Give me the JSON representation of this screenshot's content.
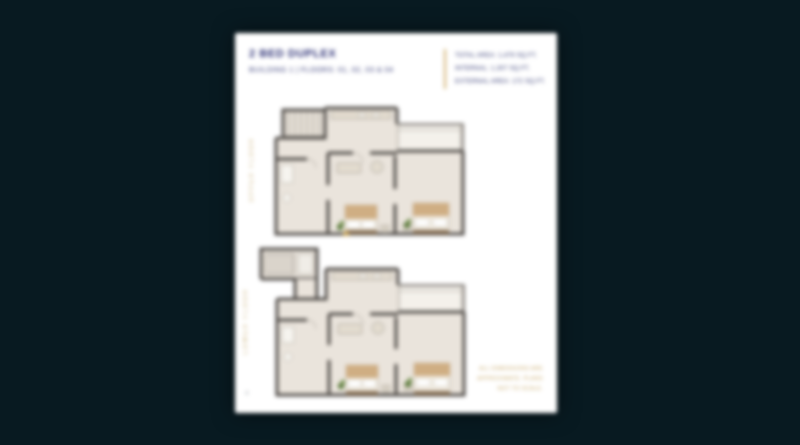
{
  "page": {
    "background_color": "#081a21",
    "paper_color": "#ffffff"
  },
  "header": {
    "title": "2 BED DUPLEX",
    "subtitle": "BUILDING 1  |  FLOORS: 01, 02, 03 & 04",
    "area_lines": [
      "TOTAL AREA: 1,479 SQ.FT.",
      "INTERNAL: 1,307 SQ.FT.",
      "EXTERNAL AREA: 172 SQ.FT."
    ]
  },
  "plans": [
    {
      "id": "upper-floor",
      "label": "UPPER FLOOR"
    },
    {
      "id": "lower-floor",
      "label": "LOWER FLOOR"
    }
  ],
  "footnote": {
    "lines": [
      "ALL DIMENSIONS ARE",
      "APPROXIMATE. PLANS",
      "NOT TO SCALE."
    ]
  },
  "footer": {
    "page_number": "4"
  },
  "colors": {
    "heading_navy": "#2f3377",
    "accent_gold": "#c9a85f",
    "wall_gray": "#4f4b47",
    "floor_beige": "#eae4dc",
    "balcony_beige": "#f4f1eb",
    "bed_tan": "#cfae83",
    "plant_green": "#5d7c3e"
  }
}
